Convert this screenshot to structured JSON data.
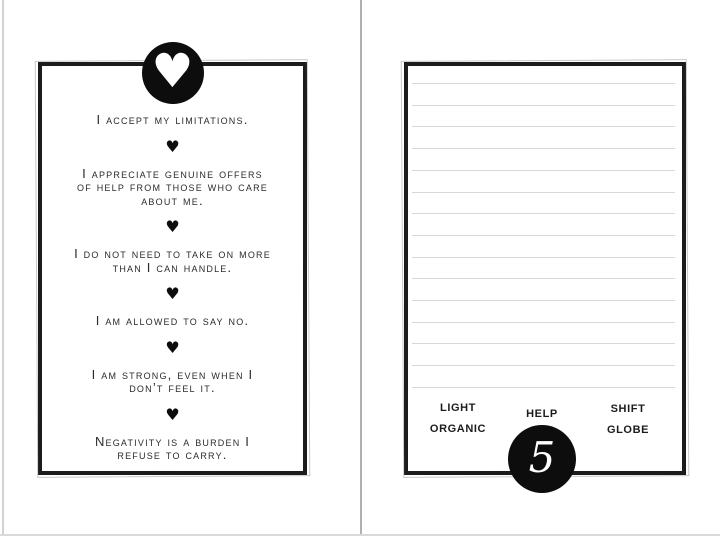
{
  "icons": {
    "heart": "♥",
    "badge": "heart-in-circle"
  },
  "page_left": {
    "affirmations": [
      {
        "lines": [
          "I accept my limitations."
        ]
      },
      {
        "lines": [
          "I appreciate genuine offers",
          "of help from those who care",
          "about me."
        ]
      },
      {
        "lines": [
          "I do not need to take on more",
          "than I can handle."
        ]
      },
      {
        "lines": [
          "I am allowed to say no."
        ]
      },
      {
        "lines": [
          "I am strong, even when I",
          "don’t feel it."
        ]
      },
      {
        "lines": [
          "Negativity is a burden I",
          "refuse to carry."
        ]
      }
    ]
  },
  "page_right": {
    "ruled_lines": 15,
    "words": [
      "LIGHT",
      "HELP",
      "SHIFT",
      "ORGANIC",
      "GLOBE"
    ],
    "page_number": "5"
  },
  "colors": {
    "ink": "#2b2b2b",
    "frame": "#1b1b1b",
    "badge_fill": "#0d0d0d",
    "rule_line": "#d8d8d8",
    "spine": "#b0b0b0",
    "page_edge": "#d9d9d9",
    "background": "#ffffff"
  }
}
